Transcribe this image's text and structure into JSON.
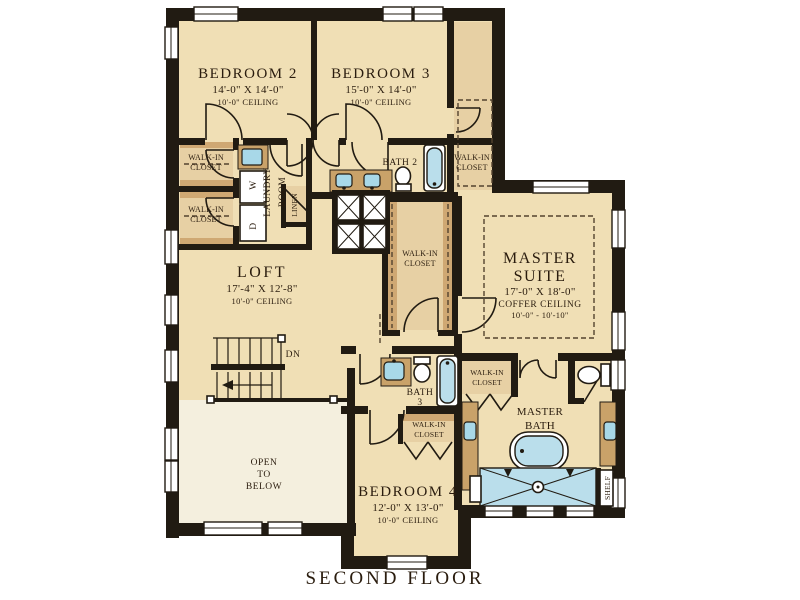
{
  "title": "SECOND FLOOR",
  "labels": {
    "walk_in_closet_line1": "WALK-IN",
    "walk_in_closet_line2": "CLOSET",
    "dn": "DN",
    "shelf": "SHELF",
    "washer": "W",
    "dryer": "D",
    "linen": "LINEN",
    "laundry_line1": "LAUNDRY",
    "laundry_line2": "ROOM",
    "open_line1": "OPEN",
    "open_line2": "TO",
    "open_line3": "BELOW"
  },
  "rooms": {
    "bedroom2": {
      "name": "BEDROOM 2",
      "dims": "14'-0\" X 14'-0\"",
      "ceiling": "10'-0\" CEILING"
    },
    "bedroom3": {
      "name": "BEDROOM 3",
      "dims": "15'-0\" X 14'-0\"",
      "ceiling": "10'-0\" CEILING"
    },
    "bedroom4": {
      "name": "BEDROOM 4",
      "dims": "12'-0\" X 13'-0\"",
      "ceiling": "10'-0\" CEILING"
    },
    "loft": {
      "name": "LOFT",
      "dims": "17'-4\" X 12'-8\"",
      "ceiling": "10'-0\" CEILING"
    },
    "master_suite": {
      "name1": "MASTER",
      "name2": "SUITE",
      "dims": "17'-0\" X 18'-0\"",
      "ceiling_type": "COFFER CEILING",
      "ceiling_height": "10'-0\" - 10'-10\""
    },
    "master_bath": {
      "name1": "MASTER",
      "name2": "BATH"
    },
    "bath2": {
      "name": "BATH 2"
    },
    "bath3": {
      "name1": "BATH",
      "name2": "3"
    }
  },
  "colors": {
    "floor": "#f0dfb5",
    "open_below_floor": "#f4efde",
    "wall": "#211b12",
    "fixture_blue": "#badeeb",
    "casework": "#c9a269",
    "closet_fill": "#e7d0a4"
  }
}
